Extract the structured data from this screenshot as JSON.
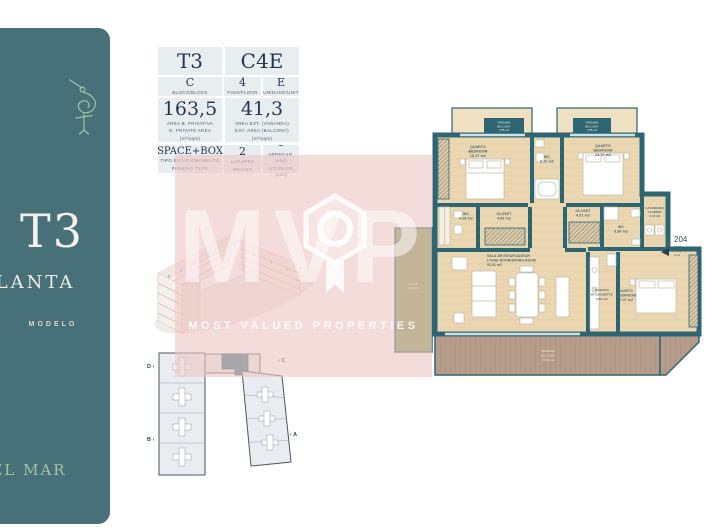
{
  "sidebar": {
    "bg": "#477079",
    "logo_icon": "stork-icon",
    "title": "T3",
    "subtitle": "PLANTA",
    "tag": "MODELO",
    "brand": "DEL MAR"
  },
  "info_table": {
    "type": "T3",
    "code": "C4E",
    "block": {
      "value": "C",
      "label": "BLOCO/BLOCK"
    },
    "floor": {
      "value": "4",
      "label": "PISO/FLOOR"
    },
    "unit": {
      "value": "E",
      "label": "UNIDADE/UNIT"
    },
    "private_area": {
      "value": "163,5",
      "label_pt": "ÁREA B. PRIVATIVA",
      "label_en": "G. PRIVATE AREA",
      "unit": "(m²/sqm)"
    },
    "ext_area": {
      "value": "41,3",
      "label_pt": "ÁREA EXT. (VARANDA)",
      "label_en": "EXT. AREA (BALCONY)",
      "unit": "(m²/sqm)"
    },
    "parking": {
      "value": "SPACE+BOX",
      "label_pt": "TIPO ESTACIONAMENTO",
      "label_en": "PARKING TYPE"
    },
    "spaces": {
      "value": "2",
      "label_pt": "LUGARES",
      "label_en": "SPACES"
    },
    "storage": {
      "value": "–",
      "label_pt": "ARRECAD. (und)",
      "label_en": "STORAGE (unit)"
    }
  },
  "floorplan": {
    "wall_color": "#2e6573",
    "floor_color": "#ead7b1",
    "rooms": [
      {
        "id": "bedroom-1",
        "pt": "QUARTO",
        "en": "BEDROOM",
        "area": "16.17 m2"
      },
      {
        "id": "wc-1",
        "pt": "WC",
        "area": "5.10 m2"
      },
      {
        "id": "bedroom-2",
        "pt": "QUARTO",
        "en": "BEDROOM",
        "area": "14.19 m2"
      },
      {
        "id": "wc-2",
        "pt": "WC",
        "area": "4.18 m2"
      },
      {
        "id": "closet-1",
        "pt": "CLOSET",
        "area": "4.69 m2"
      },
      {
        "id": "closet-2",
        "pt": "CLOSET",
        "area": "4.51 m2"
      },
      {
        "id": "wc-3",
        "pt": "WC",
        "area": "3.39 m2"
      },
      {
        "id": "laundry",
        "pt": "LAVANDARIA",
        "en": "LAUNDRY",
        "area": "3.44 m2"
      },
      {
        "id": "living",
        "pt": "SALA DE ESTAR/JANTAR",
        "en": "LIVING ROOM/DINING ROOM",
        "area": "33.91 m2"
      },
      {
        "id": "kitchen",
        "pt": "COZINHA",
        "en": "KITCHENETTE",
        "area": "8.60 m2"
      },
      {
        "id": "bedroom-3",
        "pt": "QUARTO",
        "en": "BEDROOM",
        "area": "17.07 m2"
      }
    ],
    "balcony_1": {
      "pt": "VARANDA",
      "en": "BALCONY",
      "area": "1.85 m2"
    },
    "balcony_2": {
      "pt": "VARANDA",
      "en": "BALCONY",
      "area": "1.85 m2"
    },
    "balcony_main": {
      "pt": "VARANDA",
      "en": "BALCONY",
      "area": "37.60 m2"
    },
    "garden": {
      "pt": "JARDIM",
      "en": "GARDEN"
    },
    "unit_note": {
      "number": "204",
      "lines": [
        "AP TO",
        "PA TO",
        "(m²/s"
      ]
    }
  },
  "site_plan": {
    "markers": {
      "d": "D ›",
      "c": "‹ C",
      "b": "B ›",
      "a": "‹ A"
    }
  },
  "watermark": {
    "letters": "MVP",
    "tagline": "MOST VALUED PROPERTIES",
    "badge": "medal-hexagon-icon",
    "color": "#eec6c4"
  }
}
